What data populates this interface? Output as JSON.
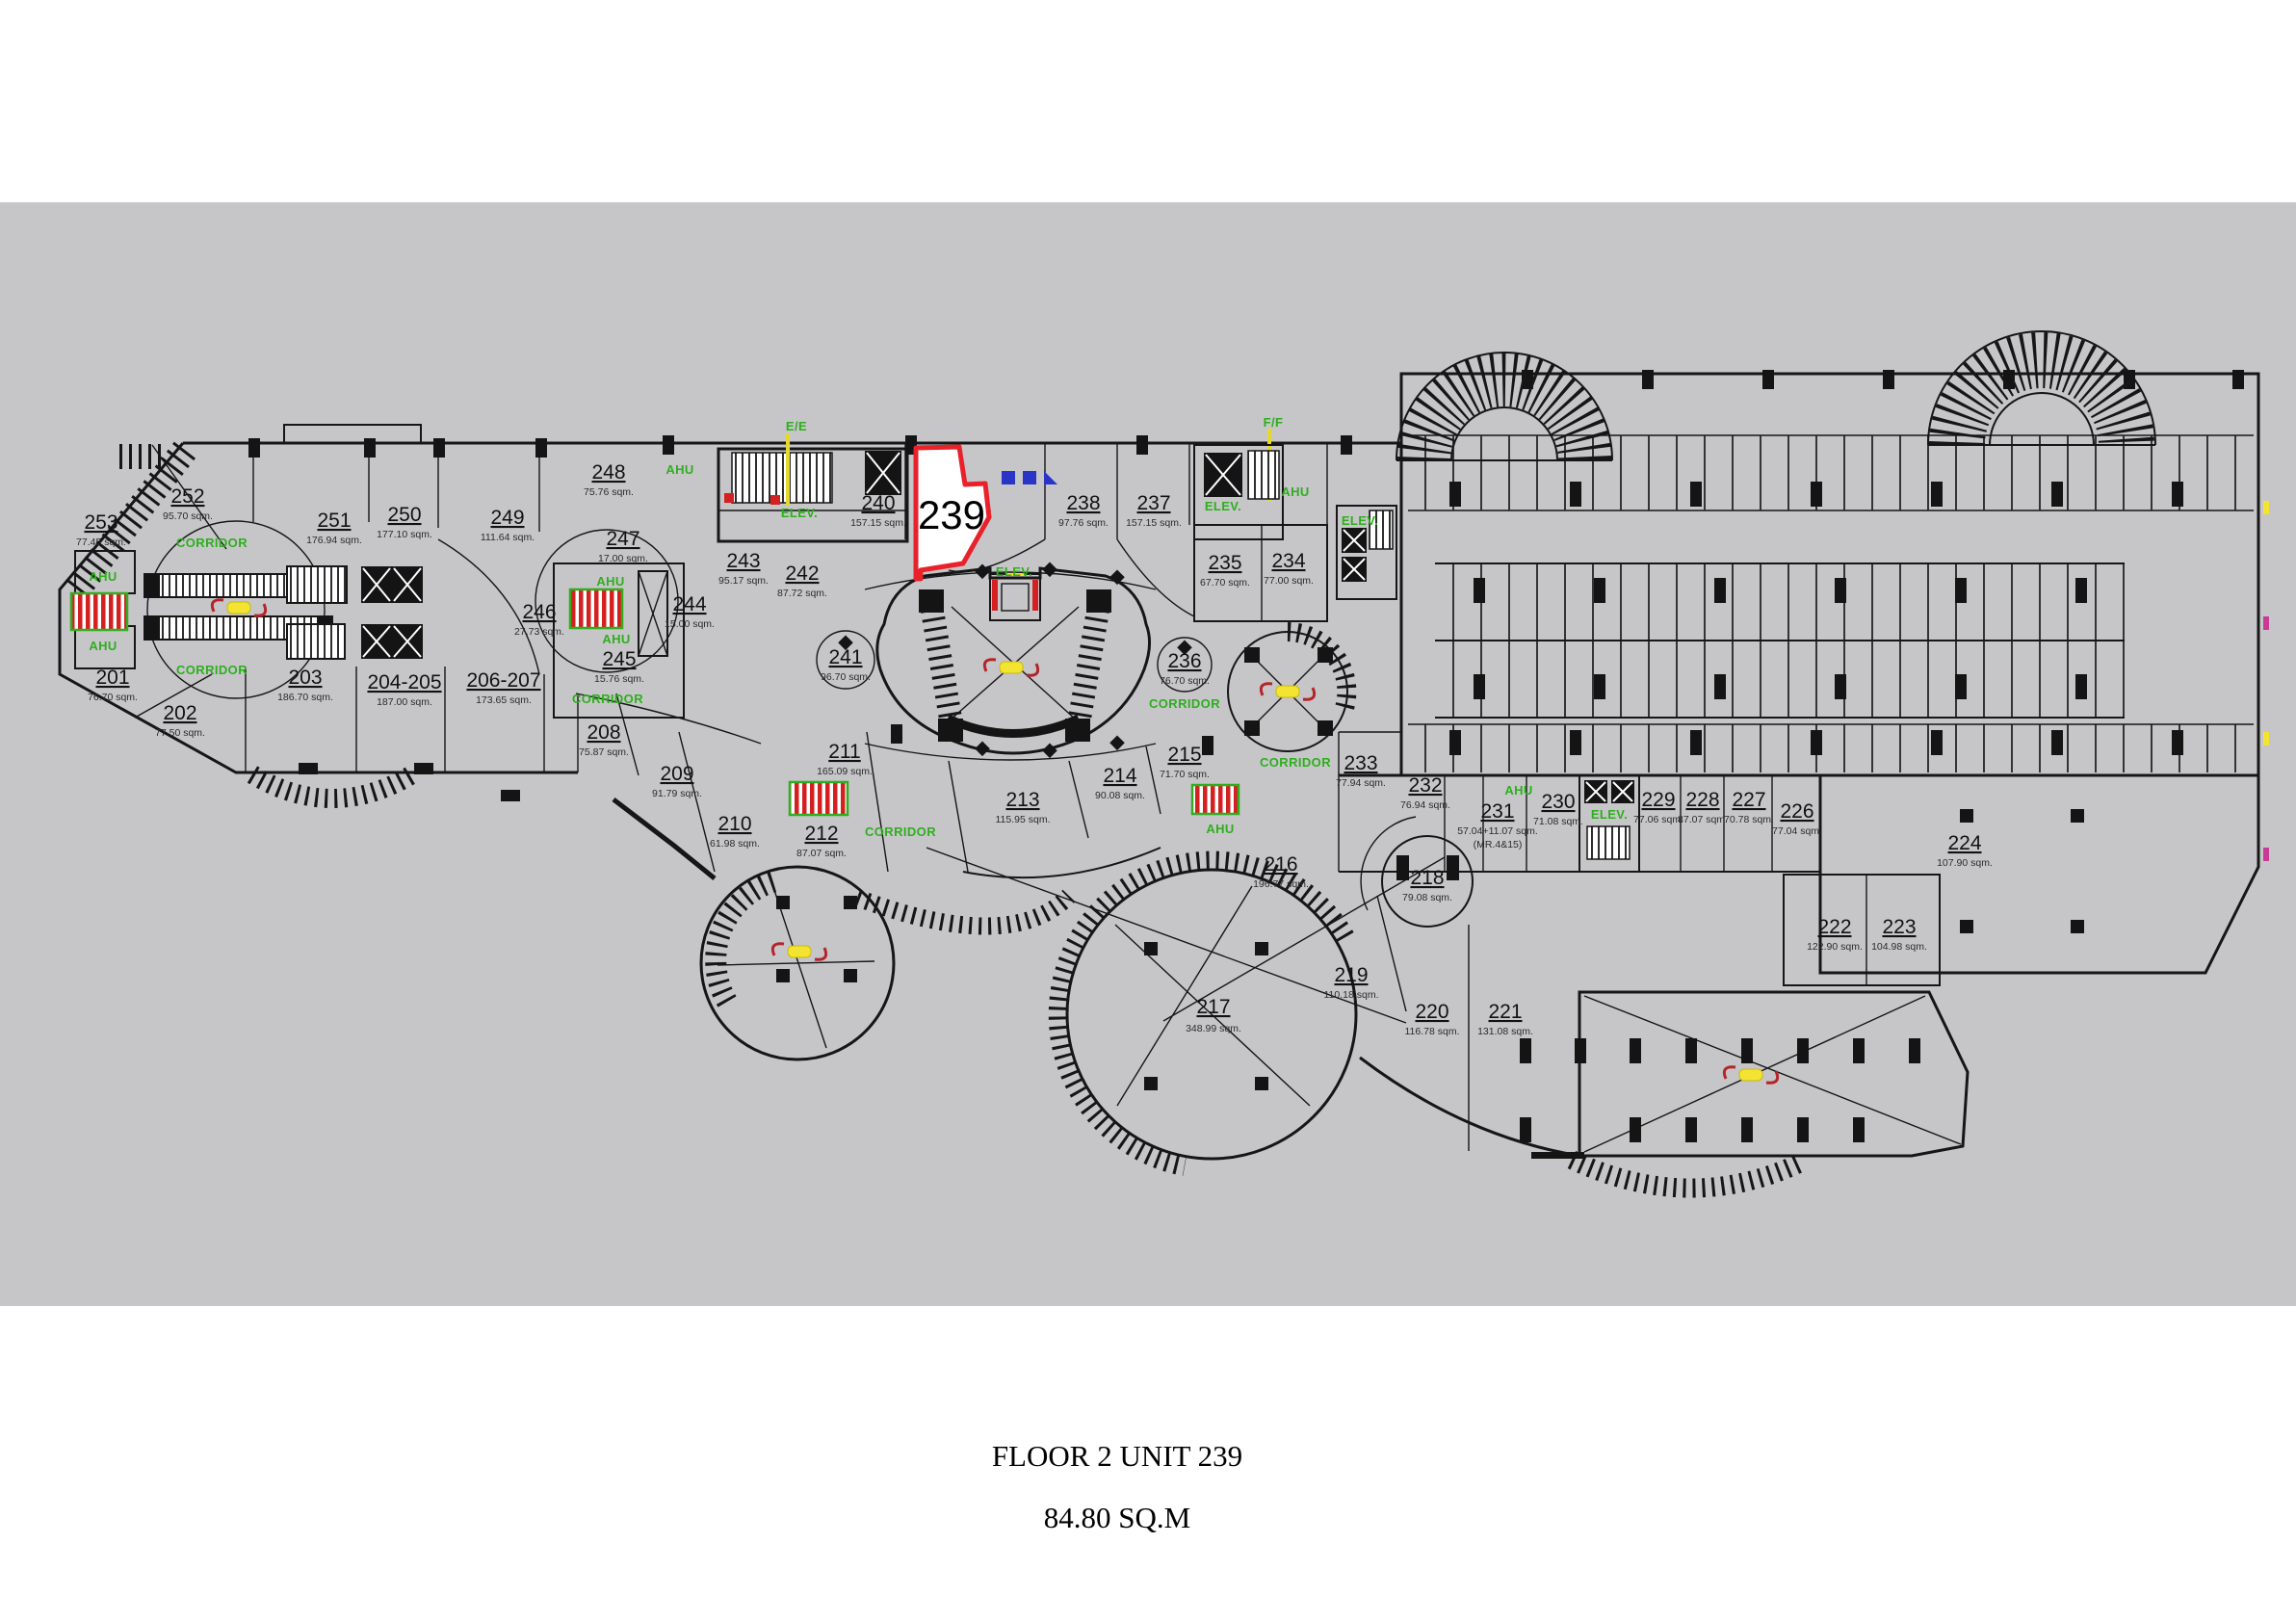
{
  "caption": {
    "line1": "FLOOR 2 UNIT 239",
    "line2": "84.80 SQ.M"
  },
  "highlight": {
    "number": "239"
  },
  "labels": {
    "corridor": "CORRIDOR",
    "ahu": "AHU",
    "elev": "ELEV.",
    "ee": "E/E",
    "ff": "F/F"
  },
  "colors": {
    "plan_bg": "#c6c6c9",
    "line": "#161616",
    "highlight_red": "#e8212b",
    "label_green": "#2fae1e",
    "accent_yellow": "#f2e430",
    "accent_blue": "#2a35c8",
    "equip_red": "#d42020"
  },
  "units": {
    "u201": {
      "number": "201",
      "area": "76.70 sqm."
    },
    "u202": {
      "number": "202",
      "area": "77.50 sqm."
    },
    "u203": {
      "number": "203",
      "area": "186.70 sqm."
    },
    "u204_205": {
      "number": "204-205",
      "area": "187.00 sqm."
    },
    "u206_207": {
      "number": "206-207",
      "area": "173.65 sqm."
    },
    "u208": {
      "number": "208",
      "area": "75.87 sqm."
    },
    "u209": {
      "number": "209",
      "area": "91.79 sqm."
    },
    "u210": {
      "number": "210",
      "area": "61.98 sqm."
    },
    "u211": {
      "number": "211",
      "area": "165.09 sqm."
    },
    "u212": {
      "number": "212",
      "area": "87.07 sqm."
    },
    "u213": {
      "number": "213",
      "area": "115.95 sqm."
    },
    "u214": {
      "number": "214",
      "area": "90.08 sqm."
    },
    "u215": {
      "number": "215",
      "area": "71.70 sqm."
    },
    "u216": {
      "number": "216",
      "area": "196.77 sqm."
    },
    "u217": {
      "number": "217",
      "area": "348.99 sqm."
    },
    "u218": {
      "number": "218",
      "area": "79.08 sqm."
    },
    "u219": {
      "number": "219",
      "area": "110.18 sqm."
    },
    "u220": {
      "number": "220",
      "area": "116.78 sqm."
    },
    "u221": {
      "number": "221",
      "area": "131.08 sqm."
    },
    "u222": {
      "number": "222",
      "area": "122.90 sqm."
    },
    "u223": {
      "number": "223",
      "area": "104.98 sqm."
    },
    "u224": {
      "number": "224",
      "area": "107.90 sqm."
    },
    "u226": {
      "number": "226",
      "area": "77.04 sqm."
    },
    "u227": {
      "number": "227",
      "area": "70.78 sqm."
    },
    "u228": {
      "number": "228",
      "area": "87.07 sqm."
    },
    "u229": {
      "number": "229",
      "area": "77.06 sqm."
    },
    "u230": {
      "number": "230",
      "area": "71.08 sqm."
    },
    "u231": {
      "number": "231",
      "area": "57.04+11.07 sqm.",
      "area2": "(MR.4&15)"
    },
    "u232": {
      "number": "232",
      "area": "76.94 sqm."
    },
    "u233": {
      "number": "233",
      "area": "77.94 sqm."
    },
    "u234": {
      "number": "234",
      "area": "77.00 sqm."
    },
    "u235": {
      "number": "235",
      "area": "67.70 sqm."
    },
    "u236": {
      "number": "236",
      "area": "76.70 sqm."
    },
    "u237": {
      "number": "237",
      "area": "157.15 sqm."
    },
    "u238": {
      "number": "238",
      "area": "97.76 sqm."
    },
    "u240": {
      "number": "240",
      "area": "157.15 sqm."
    },
    "u241": {
      "number": "241",
      "area": "96.70 sqm."
    },
    "u242": {
      "number": "242",
      "area": "87.72 sqm."
    },
    "u243": {
      "number": "243",
      "area": "95.17 sqm."
    },
    "u244": {
      "number": "244",
      "area": "15.00 sqm."
    },
    "u245": {
      "number": "245",
      "area": "15.76 sqm."
    },
    "u246": {
      "number": "246",
      "area": "27.73 sqm."
    },
    "u247": {
      "number": "247",
      "area": "17.00 sqm."
    },
    "u248": {
      "number": "248",
      "area": "75.76 sqm."
    },
    "u249": {
      "number": "249",
      "area": "111.64 sqm."
    },
    "u250": {
      "number": "250",
      "area": "177.10 sqm."
    },
    "u251": {
      "number": "251",
      "area": "176.94 sqm."
    },
    "u252": {
      "number": "252",
      "area": "95.70 sqm."
    },
    "u253": {
      "number": "253",
      "area": "77.45 sqm."
    }
  }
}
